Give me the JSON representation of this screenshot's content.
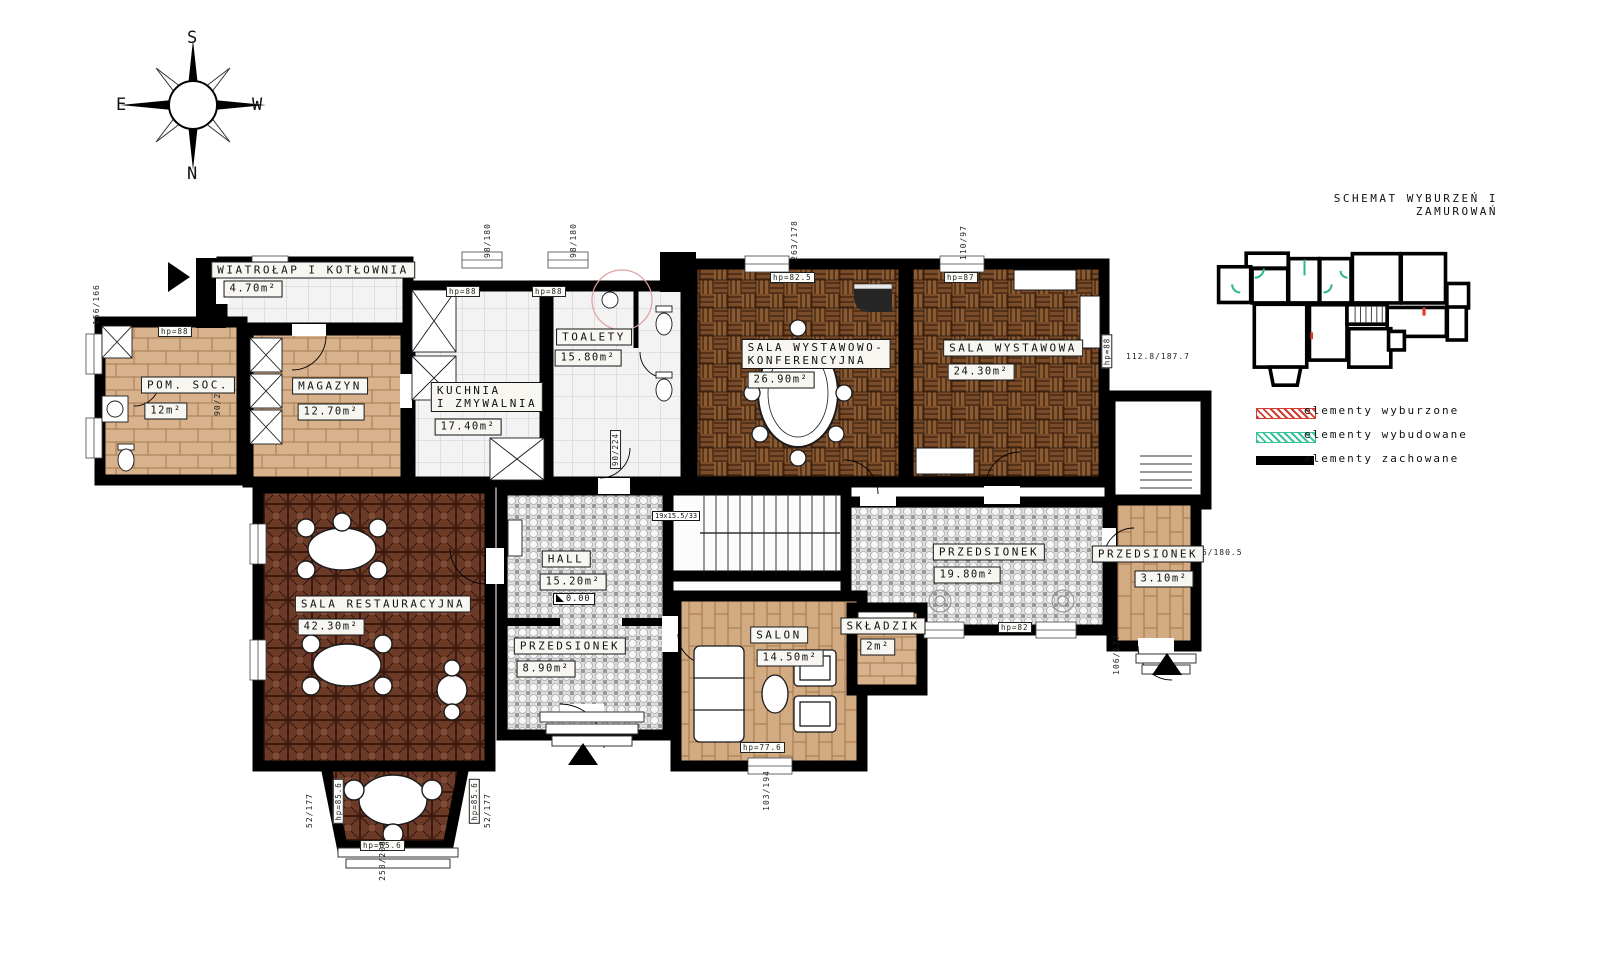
{
  "title": "SCHEMAT WYBURZEŃ I ZAMUROWAŃ",
  "compass": {
    "top": "S",
    "bottom": "N",
    "left": "E",
    "right": "W"
  },
  "legend": [
    {
      "label": "elementy wyburzone",
      "color": "#d23b2f",
      "style": "hatch"
    },
    {
      "label": "elementy wybudowane",
      "color": "#35c39a",
      "style": "hatch"
    },
    {
      "label": "elementy zachowane",
      "color": "#000000",
      "style": "solid"
    }
  ],
  "rooms": [
    {
      "name": "WIATROŁAP I KOTŁOWNIA",
      "area": "4.70m²"
    },
    {
      "name": "POM. SOC.",
      "area": "12m²"
    },
    {
      "name": "MAGAZYN",
      "area": "12.70m²"
    },
    {
      "name": "KUCHNIA",
      "name2": "I ZMYWALNIA",
      "area": "17.40m²"
    },
    {
      "name": "TOALETY",
      "area": "15.80m²"
    },
    {
      "name": "SALA WYSTAWOWO-",
      "name2": "KONFERENCYJNA",
      "area": "26.90m²"
    },
    {
      "name": "SALA WYSTAWOWA",
      "area": "24.30m²"
    },
    {
      "name": "SALA RESTAURACYJNA",
      "area": "42.30m²"
    },
    {
      "name": "HALL",
      "area": "15.20m²"
    },
    {
      "name": "PRZEDSIONEK",
      "area": "8.90m²"
    },
    {
      "name": "SALON",
      "area": "14.50m²"
    },
    {
      "name": "SKŁADZIK",
      "area": "2m²"
    },
    {
      "name": "PRZEDSIONEK",
      "area": "19.80m²"
    },
    {
      "name": "PRZEDSIONEK",
      "area": "3.10m²"
    }
  ],
  "markers": {
    "level": "0.00",
    "stairs": "19x15.5/33"
  },
  "dims": [
    {
      "t": "98/180"
    },
    {
      "t": "98/180"
    },
    {
      "t": "263/178"
    },
    {
      "t": "110/97"
    },
    {
      "t": "156/166"
    },
    {
      "t": "hp=88"
    },
    {
      "t": "hp=88"
    },
    {
      "t": "hp=88"
    },
    {
      "t": "hp=82.5"
    },
    {
      "t": "hp=87"
    },
    {
      "t": "hp=88"
    },
    {
      "t": "112.8/187.7"
    },
    {
      "t": "90/220"
    },
    {
      "t": "90/224"
    },
    {
      "t": "hp=82"
    },
    {
      "t": "106/177"
    },
    {
      "t": "46/180.5"
    },
    {
      "t": "hp=85.6"
    },
    {
      "t": "hp=85.6"
    },
    {
      "t": "hp=85.6"
    },
    {
      "t": "52/177"
    },
    {
      "t": "52/177"
    },
    {
      "t": "258/208"
    },
    {
      "t": "hp=77.6"
    },
    {
      "t": "103/194"
    }
  ]
}
